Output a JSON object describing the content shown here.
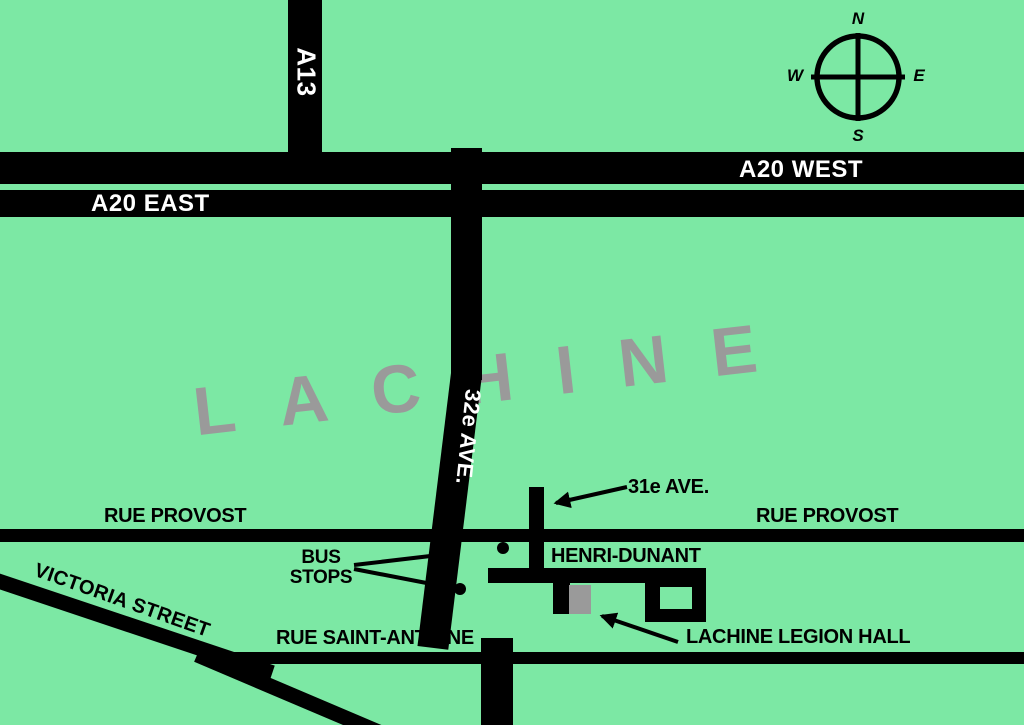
{
  "map": {
    "city_label": "LACHINE",
    "colors": {
      "background": "#7CE8A4",
      "road": "#000000",
      "city_label_gray": "#9A9A9A",
      "building_gray": "#9A9A9A",
      "highway_label_white": "#FFFFFF",
      "street_label_black": "#000000"
    },
    "highways": {
      "a13": "A13",
      "a20_east": "A20 EAST",
      "a20_west": "A20 WEST"
    },
    "streets": {
      "ave32": "32e AVE.",
      "ave31": "31e AVE.",
      "provost_left": "RUE PROVOST",
      "provost_right": "RUE PROVOST",
      "henri_dunant": "HENRI-DUNANT",
      "victoria": "VICTORIA STREET",
      "saint_antoine": "RUE SAINT-ANTOINE"
    },
    "annotations": {
      "bus_stops_line1": "BUS",
      "bus_stops_line2": "STOPS",
      "legion_hall": "LACHINE LEGION HALL"
    },
    "compass": {
      "north": "N",
      "south": "S",
      "east": "E",
      "west": "W"
    }
  }
}
